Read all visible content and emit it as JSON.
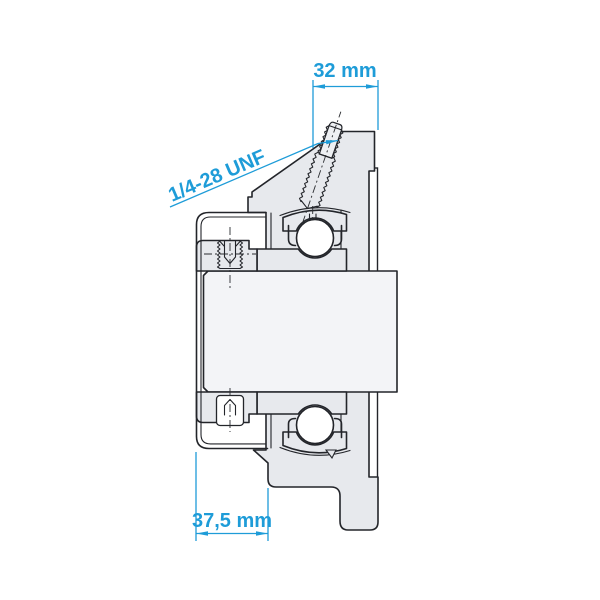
{
  "drawing": {
    "dimensions": {
      "top": {
        "label": "32 mm"
      },
      "bottom": {
        "label": "37,5 mm"
      },
      "thread": {
        "label": "1/4-28 UNF"
      }
    },
    "colors": {
      "dimension_accent": "#1e9cd8",
      "outline": "#23252a",
      "metal_fill": "#e7e9ed",
      "shaft_fill": "#f3f4f7",
      "ball_fill": "#ffffff",
      "background": "#ffffff"
    }
  }
}
